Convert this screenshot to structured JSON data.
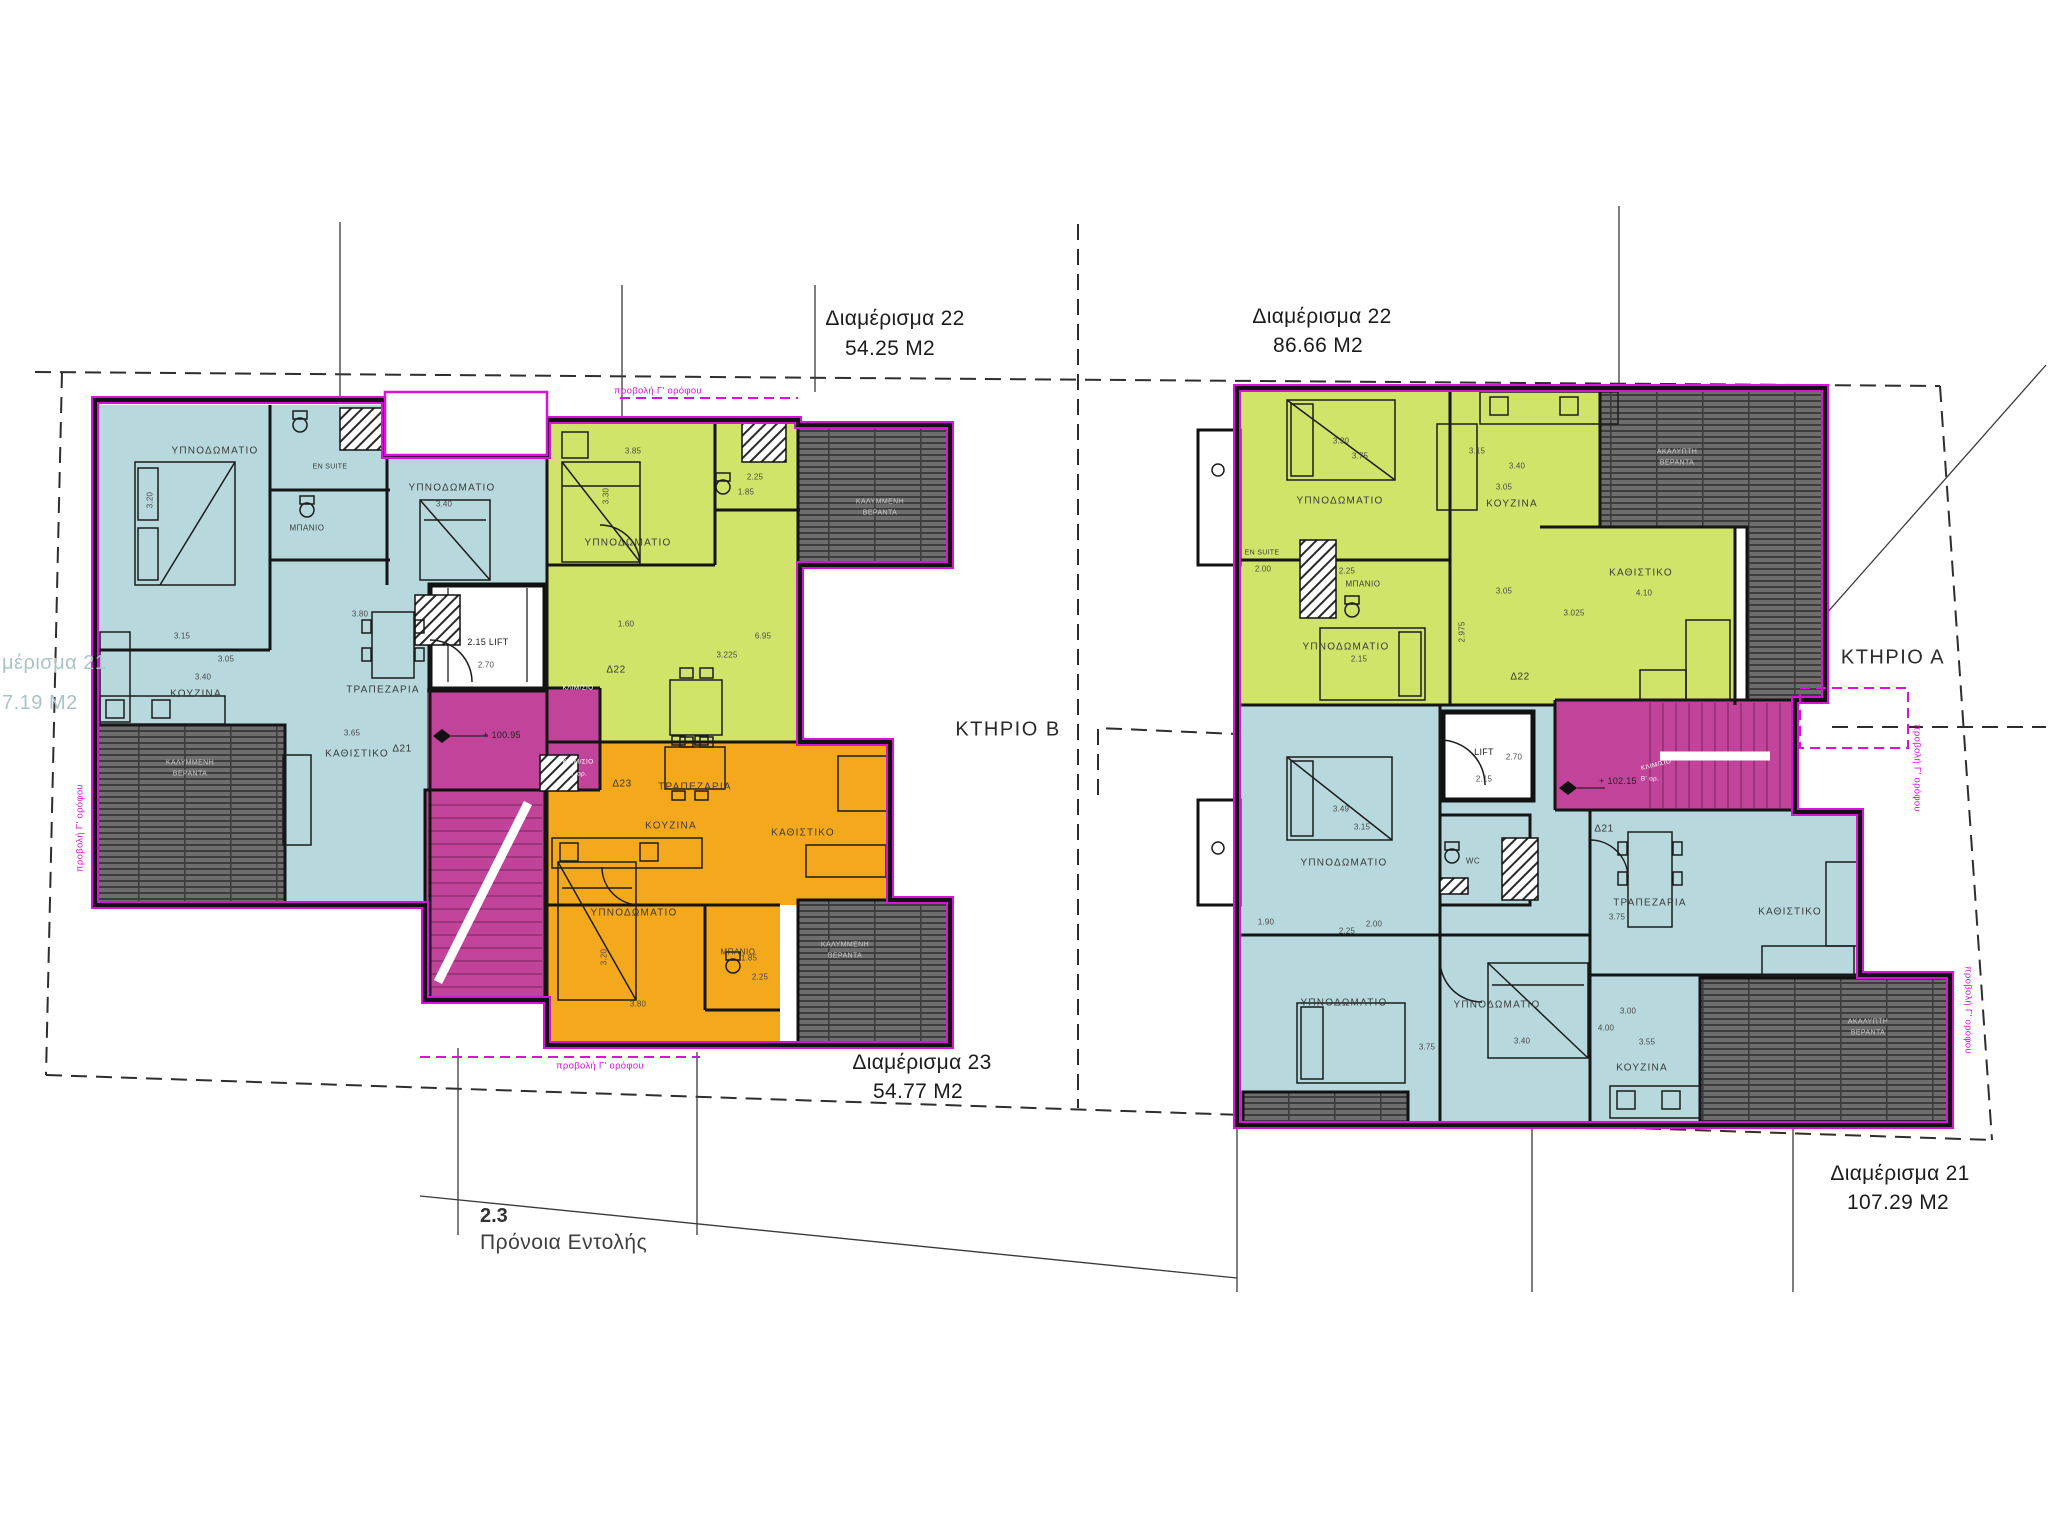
{
  "annotations": {
    "apt_b22": {
      "name": "Διαμέρισμα 22",
      "area": "54.25 M2"
    },
    "apt_a22": {
      "name": "Διαμέρισμα 22",
      "area": "86.66 M2"
    },
    "apt_b23": {
      "name": "Διαμέρισμα 23",
      "area": "54.77 M2"
    },
    "apt_a21": {
      "name": "Διαμέρισμα 21",
      "area": "107.29 M2"
    },
    "apt_edge_cut": {
      "name": "μέρισμα 21",
      "area": "7.19 M2"
    },
    "building_b": "ΚΤΗΡΙΟ Β",
    "building_a": "ΚΤΗΡΙΟ Α",
    "note_number": "2.3",
    "note_text": "Πρόνοια Εντολής",
    "projection": "προβολή Γ' ορόφου"
  },
  "rooms": {
    "bedroom": "ΥΠΝΟΔΩΜΑΤΙΟ",
    "kitchen": "ΚΟΥΖΙΝΑ",
    "dining": "ΤΡΑΠΕΖΑΡΙΑ",
    "living": "ΚΑΘΙΣΤΙΚΟ",
    "bathroom": "ΜΠΑΝΙΟ",
    "ensuite": "EN SUITE",
    "wc": "WC",
    "stair": "ΚΛΙΜ/ΣΙΟ",
    "stair_floor": "Β' ορ.",
    "veranda_covered": "ΚΑΛΥΜΜΕΝΗ",
    "veranda_uncovered": "ΑΚΑΛΥΠΤΗ",
    "veranda": "ΒΕΡΑΝΤΑ"
  },
  "units": {
    "d21": "Δ21",
    "d22": "Δ22",
    "d23": "Δ23"
  },
  "levels": {
    "left": "+ 100.95",
    "right": "+ 102.15"
  },
  "lift": {
    "left": "2.15 LIFT",
    "left_depth": "2.70",
    "right_name": "LIFT",
    "right_width": "2.70",
    "right_depth": "2.15"
  },
  "dims_left": [
    "3.15",
    "3.05",
    "3.40",
    "3.65",
    "3.80",
    "3.20",
    "3.40",
    "3.85",
    "3.30",
    "2.25",
    "1.85",
    "6.95",
    "3.225",
    "1.60",
    "3.20",
    "3.80",
    "2.25",
    "1.85"
  ],
  "dims_right": [
    "3.30",
    "3.75",
    "3.15",
    "3.40",
    "3.05",
    "2.00",
    "2.25",
    "3.05",
    "2.975",
    "3.025",
    "2.15",
    "4.10",
    "3.49",
    "3.15",
    "2.00",
    "2.25",
    "1.90",
    "3.75",
    "3.40",
    "3.75",
    "3.00",
    "4.00",
    "3.55"
  ],
  "colors": {
    "unit_blue": "#b7d9dd",
    "unit_green": "#cfe469",
    "unit_orange": "#f4a81c",
    "core_pink": "#c2439a",
    "outline_magenta": "#d911d9",
    "veranda_deck": "#6e6e6e"
  }
}
